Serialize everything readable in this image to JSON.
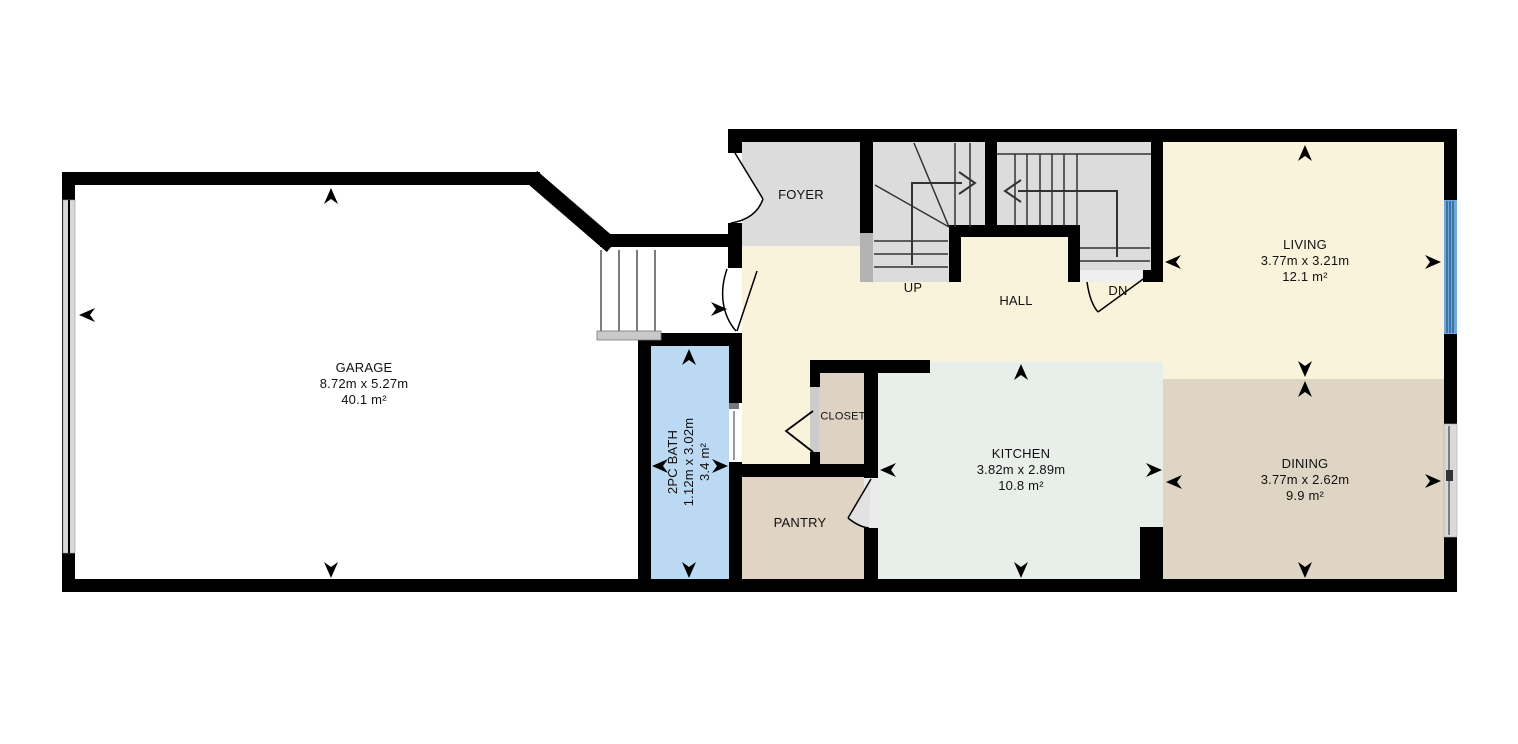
{
  "colors": {
    "wall": "#000000",
    "floor_main": "#FAF3DC",
    "floor_stairs": "#DCDCDC",
    "floor_kitchen": "#E8EEE9",
    "floor_dining": "#DED5C5",
    "floor_pantry": "#E0D4C4",
    "floor_closet": "#DDD2C3",
    "floor_bath": "#BBD9F2",
    "window_glass": "#6FA8DC"
  },
  "rooms": {
    "garage": {
      "name": "GARAGE",
      "dims": "8.72m x 5.27m",
      "area": "40.1 m²"
    },
    "foyer": {
      "name": "FOYER"
    },
    "hall": {
      "name": "HALL"
    },
    "living": {
      "name": "LIVING",
      "dims": "3.77m x 3.21m",
      "area": "12.1 m²"
    },
    "bath": {
      "name": "2PC BATH",
      "dims": "1.12m x 3.02m",
      "area": "3.4 m²"
    },
    "closet": {
      "name": "CLOSET"
    },
    "kitchen": {
      "name": "KITCHEN",
      "dims": "3.82m x 2.89m",
      "area": "10.8 m²"
    },
    "pantry": {
      "name": "PANTRY"
    },
    "dining": {
      "name": "DINING",
      "dims": "3.77m x 2.62m",
      "area": "9.9 m²"
    }
  },
  "stairs": {
    "up_label": "UP",
    "down_label": "DN"
  }
}
